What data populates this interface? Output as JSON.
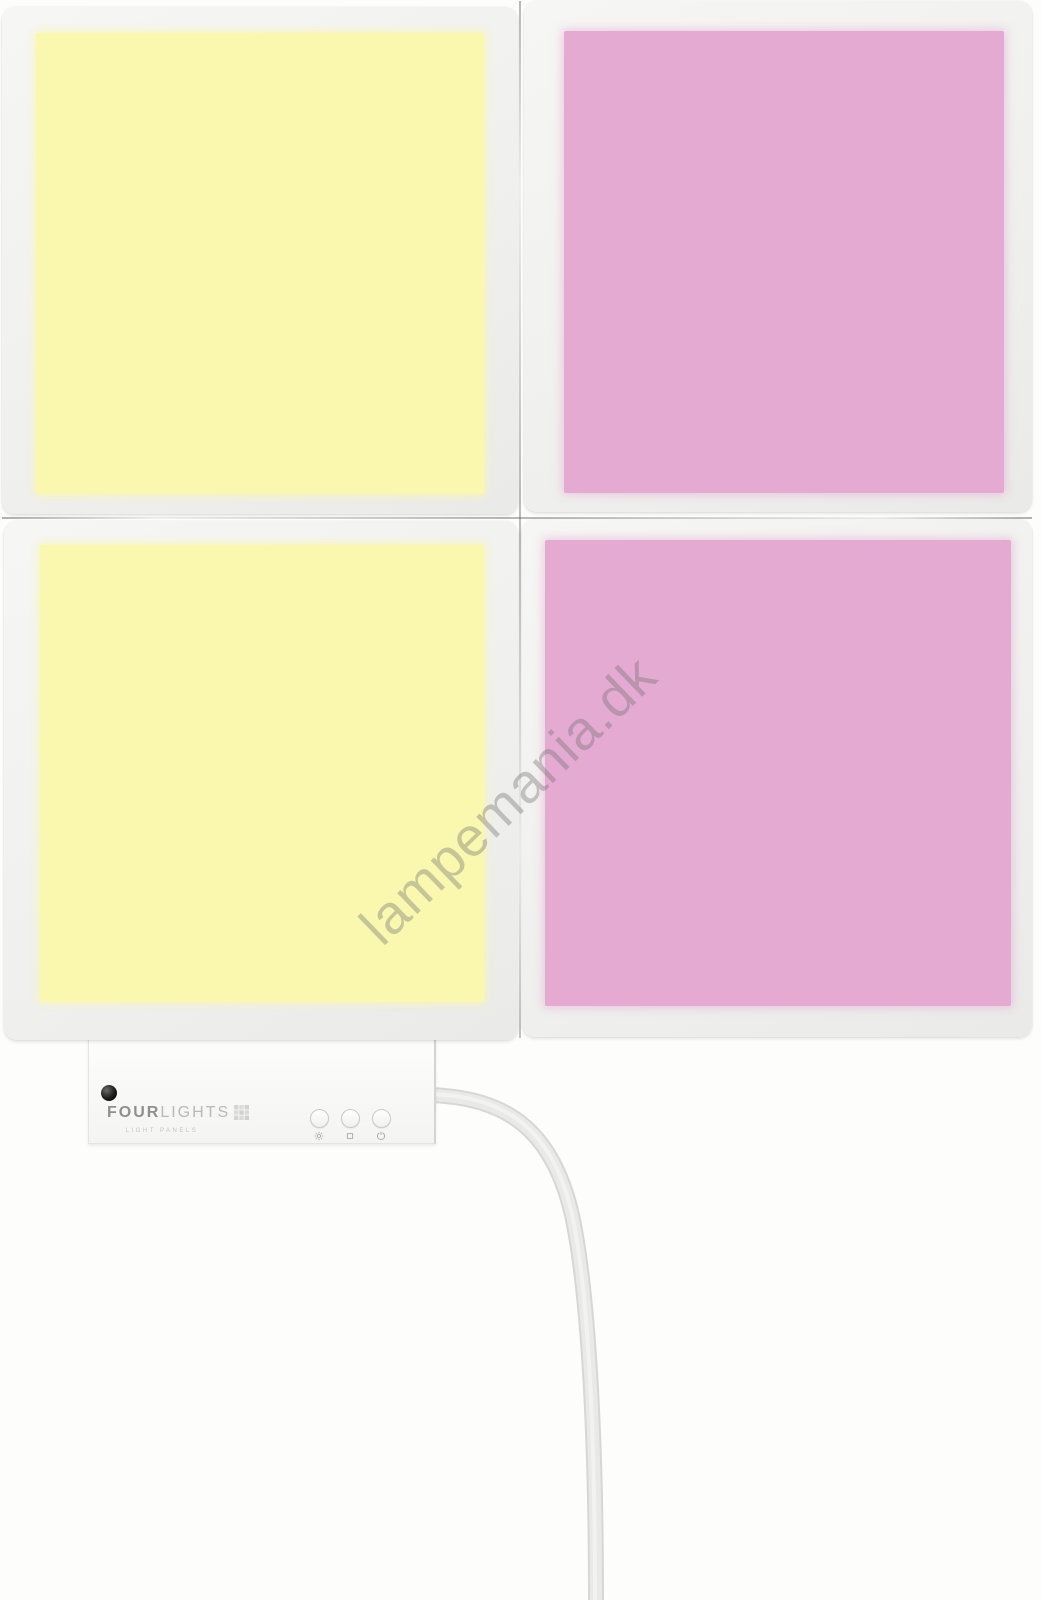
{
  "watermark": {
    "text": "lampemania.dk"
  },
  "colors": {
    "panel_yellow": "#faf8ae",
    "panel_pink": "#e4aad2",
    "frame": "#f0f0ee",
    "cable_outer": "#d7d7d5",
    "cable_inner": "#e9e9e7",
    "background": "#fdfdfc"
  },
  "panels": [
    {
      "position": "top-left",
      "glow_color_key": "panel_yellow"
    },
    {
      "position": "top-right",
      "glow_color_key": "panel_pink"
    },
    {
      "position": "bottom-left",
      "glow_color_key": "panel_yellow"
    },
    {
      "position": "bottom-right",
      "glow_color_key": "panel_pink"
    }
  ],
  "controller": {
    "brand_primary": "FOUR",
    "brand_secondary": "LIGHTS",
    "tagline": "LIGHT PANELS",
    "buttons": [
      {
        "icon": "brightness"
      },
      {
        "icon": "mode-square"
      },
      {
        "icon": "power"
      }
    ]
  }
}
